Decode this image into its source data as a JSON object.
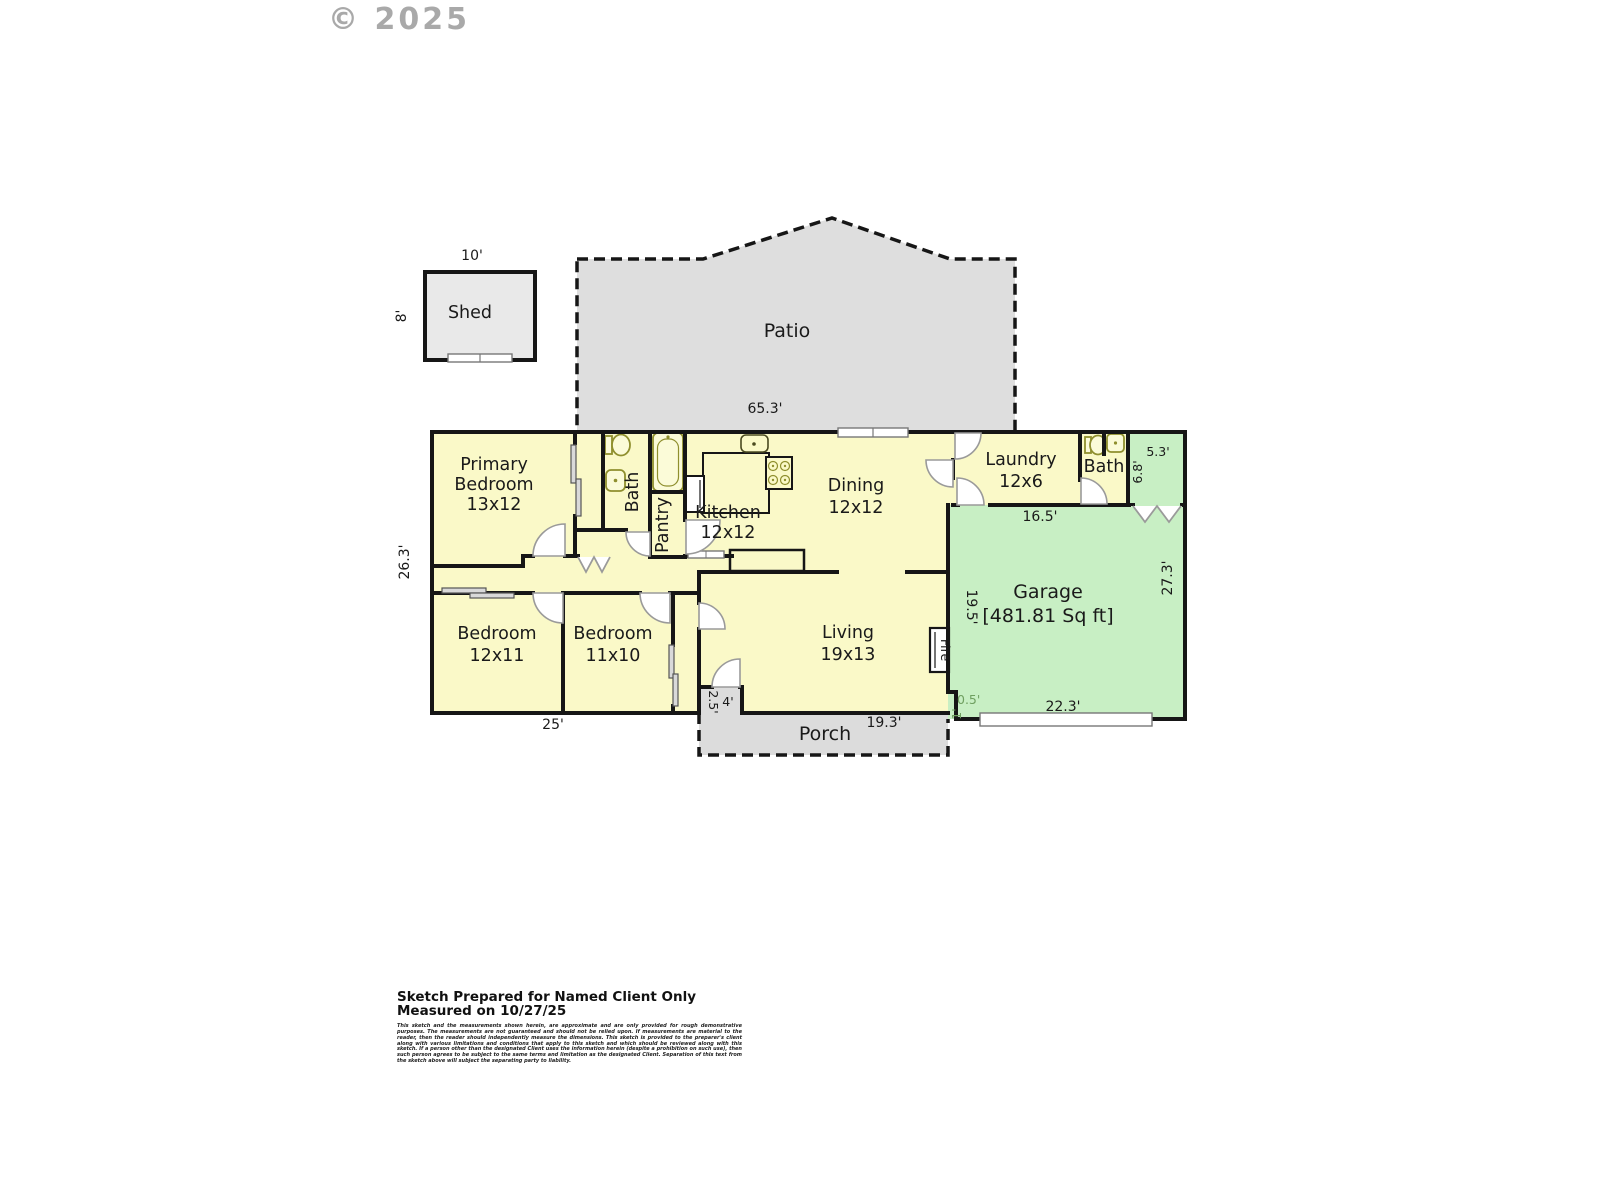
{
  "watermark": "© 2025",
  "plan": {
    "shed": {
      "label": "Shed",
      "dim_top": "10'",
      "dim_left": "8'"
    },
    "patio": {
      "label": "Patio"
    },
    "porch": {
      "label": "Porch"
    },
    "rooms": {
      "primary": {
        "line1": "Primary",
        "line2": "Bedroom",
        "dim": "13x12"
      },
      "bath1": {
        "label": "Bath"
      },
      "pantry": {
        "label": "Pantry"
      },
      "kitchen": {
        "label": "Kitchen",
        "dim": "12x12"
      },
      "dining": {
        "label": "Dining",
        "dim": "12x12"
      },
      "laundry": {
        "label": "Laundry",
        "dim": "12x6"
      },
      "bath2": {
        "label": "Bath"
      },
      "garage": {
        "label": "Garage",
        "area": "[481.81 Sq ft]"
      },
      "living": {
        "label": "Living",
        "dim": "19x13"
      },
      "bedroom2": {
        "label": "Bedroom",
        "dim": "12x11"
      },
      "bedroom3": {
        "label": "Bedroom",
        "dim": "11x10"
      },
      "fireplace": {
        "label": "Fire"
      }
    },
    "dims": {
      "house_top": "65.3'",
      "house_left": "26.3'",
      "bedrooms_bottom": "25'",
      "garage_top": "16.5'",
      "garage_left": "19.5'",
      "garage_right": "27.3'",
      "garage_bottom": "22.3'",
      "jog_a": "0.5'",
      "jog_b": "1'",
      "notch_top": "5.3'",
      "notch_side": "6.8'",
      "porch_bottom": "19.3'",
      "entry_w": "4'",
      "entry_d": "2.5'"
    }
  },
  "footer": {
    "line1": "Sketch Prepared for Named Client Only",
    "line2": "Measured on 10/27/25",
    "disclaimer": "This sketch and the measurements shown herein, are approximate and are only provided for rough demonstrative purposes.  The measurements are not guaranteed and should not be relied upon.  If measurements are material to the reader, then the reader should independently measure the dimensions.  This sketch is provided to the preparer's client along with various limitations and conditions that apply to this sketch and which should be reviewed along with this sketch.  If a person other than the designated Client uses the information herein (despite a prohibition on such use), then such person agrees to be subject to the same terms and limitation as the designated Client.  Separation of this text from the sketch above will subject the separating party to liability."
  },
  "colors": {
    "room_fill": "#faf9c8",
    "garage_fill": "#c8efc4",
    "hardscape_fill": "#dedede",
    "wall": "#161616"
  }
}
